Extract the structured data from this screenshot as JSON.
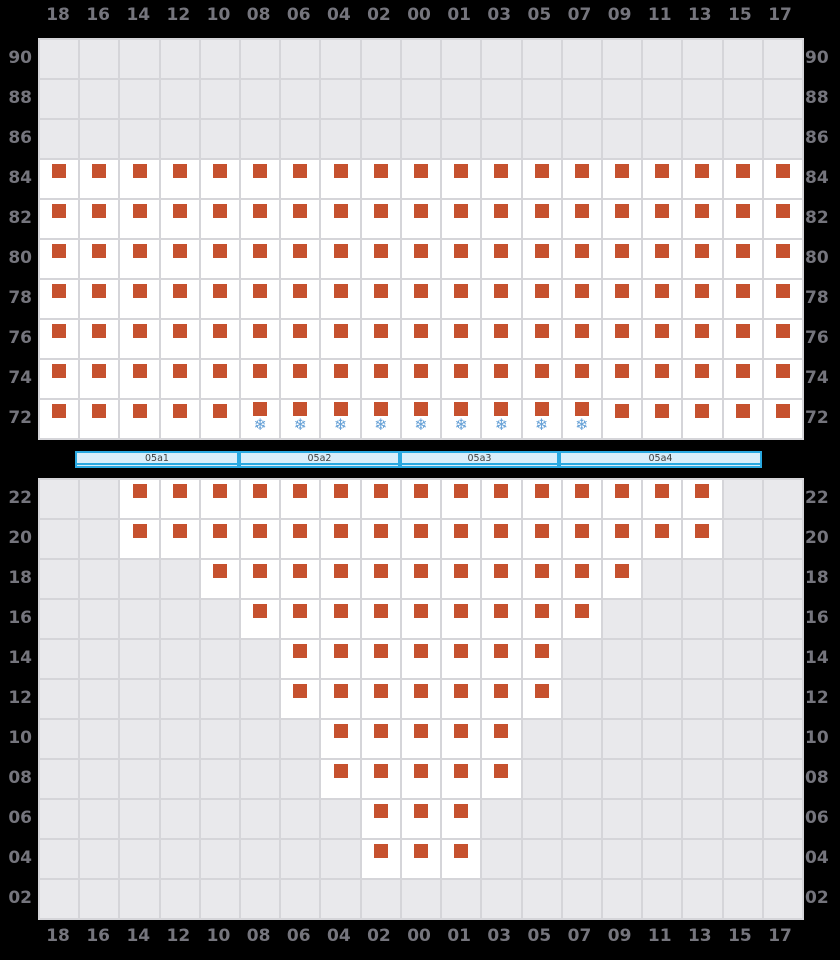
{
  "palette": {
    "background": "#000000",
    "grid_fill": "#e9e9ec",
    "grid_line": "#d5d5d9",
    "cell_white": "#ffffff",
    "marker_orange": "#c6512e",
    "snowflake_blue": "#65a0d6",
    "axis_label_gray": "#75757d",
    "bar_border_blue": "#2aa9e1",
    "bar_fill_blue": "#d9eefa",
    "bar_label_dark": "#3c3c3c"
  },
  "icons": {
    "snowflake": "❄"
  },
  "chart_data": {
    "type": "heatmap",
    "title": "",
    "xlabel": "",
    "ylabel": "",
    "grid": true,
    "columns": [
      "18",
      "16",
      "14",
      "12",
      "10",
      "08",
      "06",
      "04",
      "02",
      "00",
      "01",
      "03",
      "05",
      "07",
      "09",
      "11",
      "13",
      "15",
      "17"
    ],
    "cell_size_px": 40,
    "marker": "square",
    "blocks": [
      {
        "name": "upper",
        "top_px": 38,
        "rows": [
          {
            "label": "90",
            "from": -1,
            "to": -1
          },
          {
            "label": "88",
            "from": -1,
            "to": -1
          },
          {
            "label": "86",
            "from": -1,
            "to": -1
          },
          {
            "label": "84",
            "from": 0,
            "to": 18
          },
          {
            "label": "82",
            "from": 0,
            "to": 18
          },
          {
            "label": "80",
            "from": 0,
            "to": 18
          },
          {
            "label": "78",
            "from": 0,
            "to": 18
          },
          {
            "label": "76",
            "from": 0,
            "to": 18
          },
          {
            "label": "74",
            "from": 0,
            "to": 18
          },
          {
            "label": "72",
            "from": 0,
            "to": 18,
            "snow_from": 5,
            "snow_to": 13
          }
        ]
      },
      {
        "name": "lower",
        "top_px": 478,
        "rows": [
          {
            "label": "22",
            "from": 2,
            "to": 16
          },
          {
            "label": "20",
            "from": 2,
            "to": 16
          },
          {
            "label": "18",
            "from": 4,
            "to": 14
          },
          {
            "label": "16",
            "from": 5,
            "to": 13
          },
          {
            "label": "14",
            "from": 6,
            "to": 12
          },
          {
            "label": "12",
            "from": 6,
            "to": 12
          },
          {
            "label": "10",
            "from": 7,
            "to": 11
          },
          {
            "label": "08",
            "from": 7,
            "to": 11
          },
          {
            "label": "06",
            "from": 8,
            "to": 10
          },
          {
            "label": "04",
            "from": 8,
            "to": 10
          },
          {
            "label": "02",
            "from": -1,
            "to": -1
          }
        ]
      }
    ],
    "section_bar": {
      "segments": [
        {
          "label": "05a1",
          "left_px": 75,
          "width_px": 164
        },
        {
          "label": "05a2",
          "left_px": 239,
          "width_px": 161
        },
        {
          "label": "05a3",
          "left_px": 400,
          "width_px": 159
        },
        {
          "label": "05a4",
          "left_px": 559,
          "width_px": 203
        }
      ]
    }
  }
}
